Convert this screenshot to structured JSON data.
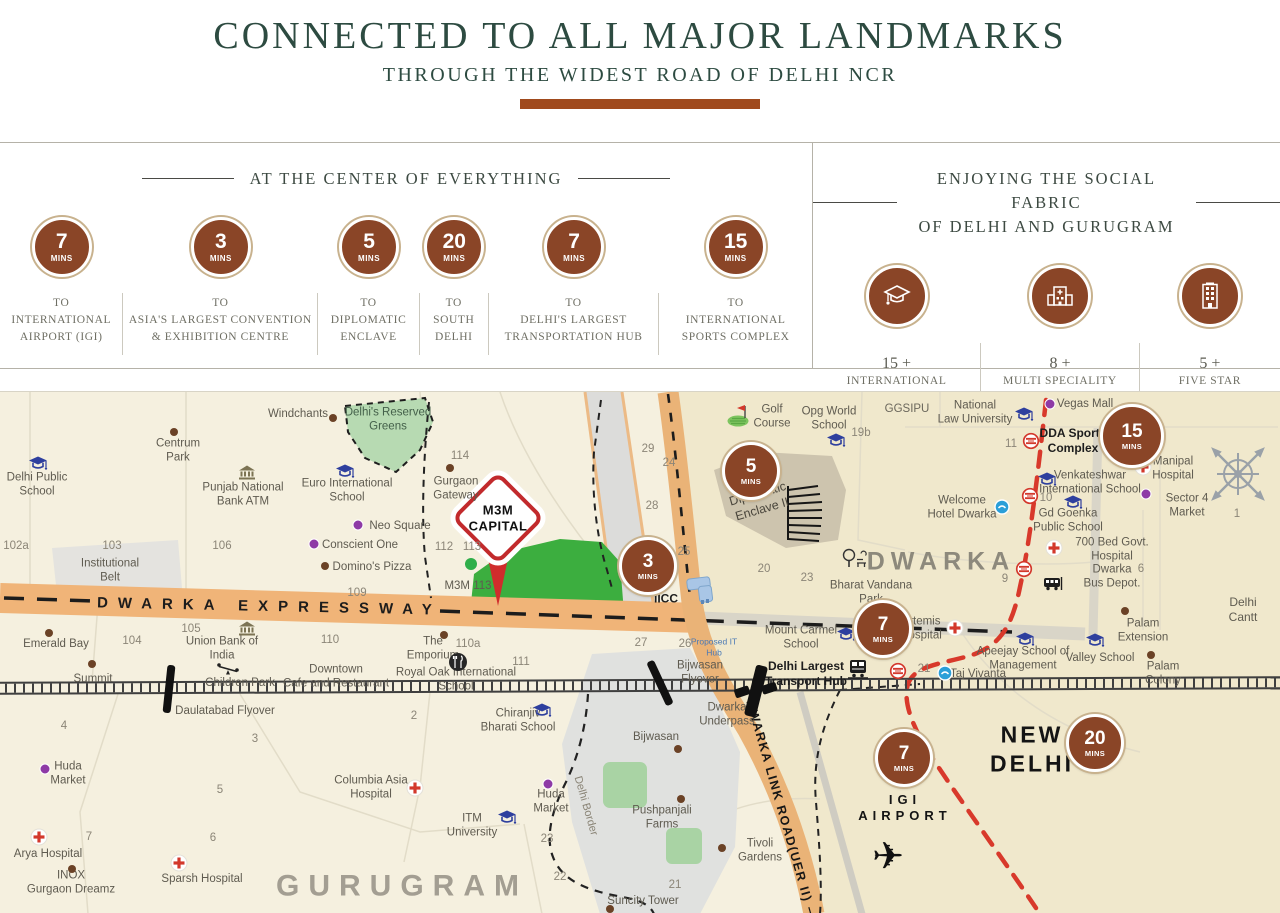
{
  "colors": {
    "title_green": "#2d4b41",
    "rule_brown": "#a04a1d",
    "badge_brown": "#8a4527",
    "expressway_orange": "#f0b478",
    "metro_red": "#d8392b",
    "park_green": "#3cae3f"
  },
  "header": {
    "title": "CONNECTED TO ALL MAJOR LANDMARKS",
    "subtitle": "THROUGH THE WIDEST ROAD OF DELHI NCR"
  },
  "panels": {
    "left": {
      "heading": "AT THE CENTER OF EVERYTHING",
      "items": [
        {
          "value": "7",
          "unit": "MINS",
          "caption": "TO\nINTERNATIONAL\nAIRPORT (IGI)"
        },
        {
          "value": "3",
          "unit": "MINS",
          "caption": "TO\nASIA'S LARGEST CONVENTION\n& EXHIBITION CENTRE"
        },
        {
          "value": "5",
          "unit": "MINS",
          "caption": "TO\nDIPLOMATIC\nENCLAVE"
        },
        {
          "value": "20",
          "unit": "MINS",
          "caption": "TO\nSOUTH\nDELHI"
        },
        {
          "value": "7",
          "unit": "MINS",
          "caption": "TO\nDELHI'S LARGEST\nTRANSPORTATION HUB"
        },
        {
          "value": "15",
          "unit": "MINS",
          "caption": "TO\nINTERNATIONAL\nSPORTS COMPLEX"
        }
      ]
    },
    "right": {
      "heading_line1": "ENJOYING THE SOCIAL FABRIC",
      "heading_line2": "OF DELHI AND GURUGRAM",
      "items": [
        {
          "icon": "school",
          "count": "15 +",
          "caption": "INTERNATIONAL\nSCHOOLS"
        },
        {
          "icon": "hospital",
          "count": "8 +",
          "caption": "MULTI SPECIALITY\nHOSPITALS"
        },
        {
          "icon": "hotel",
          "count": "5 +",
          "caption": "FIVE STAR\nHOTELS"
        }
      ]
    }
  },
  "map": {
    "roads": {
      "expressway": "DWARKA EXPRESSWAY",
      "uer2": "DWARKA LINK ROAD(UER II)"
    },
    "pin": {
      "title": "M3M\nCAPITAL"
    },
    "badges": [
      {
        "v": "5",
        "x": 751,
        "y": 79
      },
      {
        "v": "3",
        "x": 648,
        "y": 174
      },
      {
        "v": "15",
        "x": 1132,
        "y": 44,
        "d": 58
      },
      {
        "v": "7",
        "x": 883,
        "y": 237
      },
      {
        "v": "7",
        "x": 904,
        "y": 366
      },
      {
        "v": "20",
        "x": 1095,
        "y": 351
      }
    ],
    "labels": [
      {
        "t": "Windchants",
        "x": 298,
        "y": 22
      },
      {
        "t": "Centrum\nPark",
        "x": 178,
        "y": 59
      },
      {
        "t": "Delhi Public\nSchool",
        "x": 37,
        "y": 93
      },
      {
        "t": "Punjab National\nBank ATM",
        "x": 243,
        "y": 103
      },
      {
        "t": "Euro International\nSchool",
        "x": 347,
        "y": 99
      },
      {
        "t": "Delhi's Reserved\nGreens",
        "x": 388,
        "y": 28,
        "c": "#44604a"
      },
      {
        "t": "102a",
        "x": 16,
        "y": 154,
        "n": 1
      },
      {
        "t": "103",
        "x": 112,
        "y": 154,
        "n": 1
      },
      {
        "t": "106",
        "x": 222,
        "y": 154,
        "n": 1
      },
      {
        "t": "Institutional\nBelt",
        "x": 110,
        "y": 179
      },
      {
        "t": "Neo Square",
        "x": 400,
        "y": 134
      },
      {
        "t": "Conscient One",
        "x": 360,
        "y": 153
      },
      {
        "t": "Domino's Pizza",
        "x": 372,
        "y": 175
      },
      {
        "t": "109",
        "x": 357,
        "y": 201,
        "n": 1
      },
      {
        "t": "114",
        "x": 460,
        "y": 64,
        "n": 1
      },
      {
        "t": "Gurgaon\nGateway",
        "x": 456,
        "y": 97
      },
      {
        "t": "112",
        "x": 444,
        "y": 155,
        "n": 1
      },
      {
        "t": "113",
        "x": 472,
        "y": 155,
        "n": 1
      },
      {
        "t": "M3M 113",
        "x": 468,
        "y": 194
      },
      {
        "t": "29",
        "x": 648,
        "y": 57,
        "n": 1
      },
      {
        "t": "24",
        "x": 669,
        "y": 71,
        "n": 1
      },
      {
        "t": "28",
        "x": 652,
        "y": 114,
        "n": 1
      },
      {
        "t": "25",
        "x": 684,
        "y": 160,
        "n": 1
      },
      {
        "t": "IICC",
        "x": 666,
        "y": 207,
        "b": 1
      },
      {
        "t": "Golf\nCourse",
        "x": 772,
        "y": 25
      },
      {
        "t": "Opg World\nSchool",
        "x": 829,
        "y": 27
      },
      {
        "t": "19b",
        "x": 861,
        "y": 41,
        "n": 1
      },
      {
        "t": "GGSIPU",
        "x": 907,
        "y": 17,
        "c": "#6b675c"
      },
      {
        "t": "National\nLaw University",
        "x": 975,
        "y": 21
      },
      {
        "t": "Diplomatic\nEnclave II",
        "x": 760,
        "y": 110,
        "r": -16,
        "s": 12.5,
        "c": "#4a463c"
      },
      {
        "t": "Welcome\nHotel Dwarka",
        "x": 962,
        "y": 116
      },
      {
        "t": "DWARKA",
        "x": 941,
        "y": 170,
        "s": 25,
        "c": "#8d897c",
        "b": 1,
        "ls": 6,
        "id": "region-dwarka"
      },
      {
        "t": "Bharat Vandana\nPark",
        "x": 871,
        "y": 201
      },
      {
        "t": "20",
        "x": 764,
        "y": 177,
        "n": 1
      },
      {
        "t": "23",
        "x": 807,
        "y": 186,
        "n": 1
      },
      {
        "t": "Vegas Mall",
        "x": 1085,
        "y": 12
      },
      {
        "t": "DDA Sports\nComplex",
        "x": 1073,
        "y": 49,
        "b": 1
      },
      {
        "t": "11",
        "x": 1011,
        "y": 52,
        "n": 1
      },
      {
        "t": "Manipal\nHospital",
        "x": 1173,
        "y": 77
      },
      {
        "t": "Venkateshwar\nInternational School",
        "x": 1090,
        "y": 91
      },
      {
        "t": "10",
        "x": 1046,
        "y": 106,
        "n": 1
      },
      {
        "t": "Sector 4\nMarket",
        "x": 1187,
        "y": 114
      },
      {
        "t": "Gd Goenka\nPublic School",
        "x": 1068,
        "y": 129
      },
      {
        "t": "700 Bed Govt.\nHospital",
        "x": 1112,
        "y": 158
      },
      {
        "t": "Dwarka\nBus Depot.",
        "x": 1112,
        "y": 185
      },
      {
        "t": "6",
        "x": 1141,
        "y": 177,
        "n": 1
      },
      {
        "t": "9",
        "x": 1005,
        "y": 187,
        "n": 1
      },
      {
        "t": "1",
        "x": 1237,
        "y": 122,
        "n": 1
      },
      {
        "t": "Delhi Cantt",
        "x": 1243,
        "y": 218,
        "s": 12
      },
      {
        "t": "Palam\nExtension",
        "x": 1143,
        "y": 239
      },
      {
        "t": "Apeejay School of\nManagement",
        "x": 1023,
        "y": 267
      },
      {
        "t": "Valley School",
        "x": 1100,
        "y": 266
      },
      {
        "t": "Palam\nColony",
        "x": 1163,
        "y": 282
      },
      {
        "t": "Taj Vivanta",
        "x": 978,
        "y": 282
      },
      {
        "t": "21",
        "x": 924,
        "y": 277,
        "n": 1
      },
      {
        "t": "Artemis\nHospital",
        "x": 921,
        "y": 237
      },
      {
        "t": "Mount Carmel\nSchool",
        "x": 801,
        "y": 246
      },
      {
        "t": "Delhi Largest\nTransport Hub",
        "x": 806,
        "y": 282,
        "b": 1
      },
      {
        "t": "Dwarka\nUnderpass",
        "x": 727,
        "y": 323
      },
      {
        "t": "Bijwasan\nFlyover",
        "x": 700,
        "y": 281
      },
      {
        "t": "26",
        "x": 685,
        "y": 252,
        "n": 1
      },
      {
        "t": "Proposed IT\nHub",
        "x": 714,
        "y": 255,
        "s": 8.5,
        "c": "#4a79b5"
      },
      {
        "t": "27",
        "x": 641,
        "y": 251,
        "n": 1
      },
      {
        "t": "Bijwasan",
        "x": 656,
        "y": 345
      },
      {
        "t": "Delhi Border",
        "x": 585,
        "y": 414,
        "r": 74,
        "c": "#8a8476",
        "s": 11,
        "id": "delhi-border-label"
      },
      {
        "t": "Pushpanjali\nFarms",
        "x": 662,
        "y": 426
      },
      {
        "t": "Tivoli\nGardens",
        "x": 760,
        "y": 459
      },
      {
        "t": "Suncity Tower",
        "x": 643,
        "y": 509
      },
      {
        "t": "21",
        "x": 675,
        "y": 493,
        "n": 1
      },
      {
        "t": "22",
        "x": 560,
        "y": 485,
        "n": 1
      },
      {
        "t": "23",
        "x": 547,
        "y": 447,
        "n": 1
      },
      {
        "t": "Huda\nMarket",
        "x": 551,
        "y": 410
      },
      {
        "t": "Chiranjiv\nBharati School",
        "x": 518,
        "y": 329
      },
      {
        "t": "2",
        "x": 414,
        "y": 324,
        "n": 1
      },
      {
        "t": "Royal Oak International\nSchool",
        "x": 456,
        "y": 288
      },
      {
        "t": "111",
        "x": 521,
        "y": 270,
        "n": 1
      },
      {
        "t": "110a",
        "x": 468,
        "y": 252,
        "n": 1
      },
      {
        "t": "The\nEmporium",
        "x": 433,
        "y": 257
      },
      {
        "t": "110",
        "x": 330,
        "y": 248,
        "n": 1
      },
      {
        "t": "Downtown\nCafe and Restaurant",
        "x": 336,
        "y": 285
      },
      {
        "t": "Daulatabad Flyover",
        "x": 225,
        "y": 319
      },
      {
        "t": "Emerald Bay",
        "x": 56,
        "y": 252
      },
      {
        "t": "104",
        "x": 132,
        "y": 249,
        "n": 1
      },
      {
        "t": "Summit",
        "x": 93,
        "y": 287
      },
      {
        "t": "105",
        "x": 191,
        "y": 237,
        "n": 1
      },
      {
        "t": "Union Bank of\nIndia",
        "x": 222,
        "y": 257
      },
      {
        "t": "Children Park",
        "x": 240,
        "y": 291
      },
      {
        "t": "4",
        "x": 64,
        "y": 334,
        "n": 1
      },
      {
        "t": "3",
        "x": 255,
        "y": 347,
        "n": 1
      },
      {
        "t": "Huda\nMarket",
        "x": 68,
        "y": 382
      },
      {
        "t": "5",
        "x": 220,
        "y": 398,
        "n": 1
      },
      {
        "t": "7",
        "x": 89,
        "y": 445,
        "n": 1
      },
      {
        "t": "Arya Hospital",
        "x": 48,
        "y": 462
      },
      {
        "t": "INOX\nGurgaon Dreamz",
        "x": 71,
        "y": 491
      },
      {
        "t": "6",
        "x": 213,
        "y": 446,
        "n": 1
      },
      {
        "t": "Sparsh Hospital",
        "x": 202,
        "y": 487
      },
      {
        "t": "Columbia Asia\nHospital",
        "x": 371,
        "y": 396
      },
      {
        "t": "ITM\nUniversity",
        "x": 472,
        "y": 434
      },
      {
        "t": "GURUGRAM",
        "x": 402,
        "y": 494,
        "s": 30,
        "c": "#a39e92",
        "b": 1,
        "ls": 9,
        "id": "region-gurugram"
      },
      {
        "t": "NEW\nDELHI",
        "x": 1032,
        "y": 357,
        "s": 23,
        "c": "#141414",
        "b": 1,
        "ls": 3,
        "id": "region-new-delhi"
      },
      {
        "t": "IGI\nAIRPORT",
        "x": 905,
        "y": 416,
        "s": 13,
        "c": "#141414",
        "b": 1,
        "ls": 5,
        "id": "igi-airport-label"
      }
    ],
    "icons": [
      {
        "k": "school",
        "x": 38,
        "y": 72
      },
      {
        "k": "school",
        "x": 345,
        "y": 80
      },
      {
        "k": "school",
        "x": 836,
        "y": 49
      },
      {
        "k": "school",
        "x": 846,
        "y": 243
      },
      {
        "k": "school",
        "x": 542,
        "y": 319
      },
      {
        "k": "school",
        "x": 507,
        "y": 426
      },
      {
        "k": "school",
        "x": 1025,
        "y": 248
      },
      {
        "k": "school",
        "x": 1095,
        "y": 249
      },
      {
        "k": "school",
        "x": 1047,
        "y": 88
      },
      {
        "k": "school",
        "x": 1073,
        "y": 111
      },
      {
        "k": "school",
        "x": 1024,
        "y": 23
      },
      {
        "k": "hospital",
        "x": 955,
        "y": 236
      },
      {
        "k": "hospital",
        "x": 1143,
        "y": 75
      },
      {
        "k": "hospital",
        "x": 1054,
        "y": 156
      },
      {
        "k": "hospital",
        "x": 415,
        "y": 396
      },
      {
        "k": "hospital",
        "x": 39,
        "y": 445
      },
      {
        "k": "hospital",
        "x": 179,
        "y": 471
      },
      {
        "k": "metro",
        "x": 1031,
        "y": 49
      },
      {
        "k": "metro",
        "x": 1030,
        "y": 104
      },
      {
        "k": "metro",
        "x": 1024,
        "y": 177
      },
      {
        "k": "metro",
        "x": 898,
        "y": 279
      },
      {
        "k": "bank",
        "x": 247,
        "y": 81
      },
      {
        "k": "bank",
        "x": 247,
        "y": 237
      },
      {
        "k": "dot-brown",
        "x": 333,
        "y": 26
      },
      {
        "k": "dot-brown",
        "x": 174,
        "y": 40
      },
      {
        "k": "dot-brown",
        "x": 450,
        "y": 76
      },
      {
        "k": "dot-brown",
        "x": 444,
        "y": 243
      },
      {
        "k": "dot-brown",
        "x": 49,
        "y": 241
      },
      {
        "k": "dot-brown",
        "x": 92,
        "y": 272
      },
      {
        "k": "dot-brown",
        "x": 72,
        "y": 477
      },
      {
        "k": "dot-brown",
        "x": 610,
        "y": 517
      },
      {
        "k": "dot-brown",
        "x": 678,
        "y": 357
      },
      {
        "k": "dot-brown",
        "x": 681,
        "y": 407
      },
      {
        "k": "dot-brown",
        "x": 722,
        "y": 456
      },
      {
        "k": "dot-brown",
        "x": 1125,
        "y": 219
      },
      {
        "k": "dot-brown",
        "x": 1151,
        "y": 263
      },
      {
        "k": "dot-brown",
        "x": 325,
        "y": 174
      },
      {
        "k": "dot-purple",
        "x": 358,
        "y": 133
      },
      {
        "k": "dot-purple",
        "x": 314,
        "y": 152
      },
      {
        "k": "dot-purple",
        "x": 45,
        "y": 377
      },
      {
        "k": "dot-purple",
        "x": 548,
        "y": 392
      },
      {
        "k": "dot-purple",
        "x": 1050,
        "y": 12
      },
      {
        "k": "dot-purple",
        "x": 1146,
        "y": 102
      },
      {
        "k": "dot-green",
        "x": 471,
        "y": 172
      },
      {
        "k": "blue",
        "x": 1002,
        "y": 115
      },
      {
        "k": "blue",
        "x": 945,
        "y": 281
      },
      {
        "k": "train",
        "x": 858,
        "y": 277
      },
      {
        "k": "bus",
        "x": 1053,
        "y": 192
      },
      {
        "k": "tree",
        "x": 855,
        "y": 167
      },
      {
        "k": "golf",
        "x": 741,
        "y": 24
      },
      {
        "k": "restaurant",
        "x": 458,
        "y": 270
      },
      {
        "k": "seesaw",
        "x": 228,
        "y": 277
      },
      {
        "k": "compass",
        "x": 1238,
        "y": 82
      },
      {
        "k": "plane",
        "x": 888,
        "y": 469
      },
      {
        "k": "underpass",
        "x": 756,
        "y": 299
      },
      {
        "k": "flyover",
        "x": 169,
        "y": 297,
        "r": 6
      },
      {
        "k": "flyover",
        "x": 660,
        "y": 291,
        "r": -25
      },
      {
        "k": "iicc",
        "x": 703,
        "y": 199
      }
    ]
  }
}
